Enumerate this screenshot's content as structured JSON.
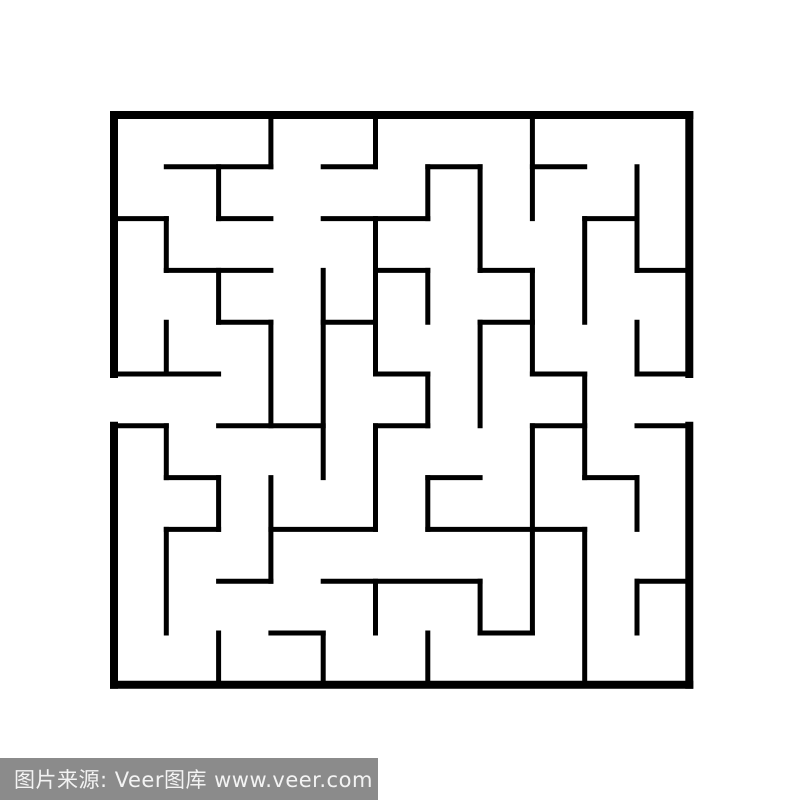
{
  "page": {
    "background": "#ffffff"
  },
  "maze": {
    "wall_color": "#000000",
    "background": "#ffffff",
    "grid": {
      "cols": 11,
      "rows": 11,
      "origin_x": 114,
      "origin_y": 115,
      "cell_w": 52.3,
      "cell_h": 51.8
    },
    "outer_wall_thickness": 8,
    "inner_wall_thickness": 5,
    "entrances": [
      {
        "side": "left",
        "row": 5
      },
      {
        "side": "right",
        "row": 5
      }
    ],
    "h_walls": [
      [
        0,
        0,
        11
      ],
      [
        1,
        1,
        3
      ],
      [
        1,
        4,
        5
      ],
      [
        1,
        6,
        7
      ],
      [
        1,
        8,
        9
      ],
      [
        2,
        0,
        1
      ],
      [
        2,
        2,
        3
      ],
      [
        2,
        4,
        6
      ],
      [
        2,
        9,
        10
      ],
      [
        3,
        1,
        3
      ],
      [
        3,
        5,
        6
      ],
      [
        3,
        7,
        8
      ],
      [
        3,
        10,
        11
      ],
      [
        4,
        2,
        3
      ],
      [
        4,
        4,
        5
      ],
      [
        4,
        7,
        8
      ],
      [
        5,
        0,
        2
      ],
      [
        5,
        5,
        6
      ],
      [
        5,
        8,
        9
      ],
      [
        5,
        10,
        11
      ],
      [
        6,
        0,
        1
      ],
      [
        6,
        2,
        4
      ],
      [
        6,
        5,
        6
      ],
      [
        6,
        8,
        9
      ],
      [
        6,
        10,
        11
      ],
      [
        7,
        1,
        2
      ],
      [
        7,
        6,
        7
      ],
      [
        7,
        9,
        10
      ],
      [
        8,
        1,
        2
      ],
      [
        8,
        3,
        5
      ],
      [
        8,
        6,
        9
      ],
      [
        9,
        2,
        3
      ],
      [
        9,
        4,
        7
      ],
      [
        9,
        10,
        11
      ],
      [
        10,
        3,
        4
      ],
      [
        10,
        7,
        8
      ],
      [
        11,
        0,
        11
      ]
    ],
    "v_walls": [
      [
        0,
        0,
        5
      ],
      [
        0,
        6,
        11
      ],
      [
        1,
        2,
        3
      ],
      [
        1,
        4,
        5
      ],
      [
        1,
        6,
        7
      ],
      [
        1,
        8,
        10
      ],
      [
        2,
        1,
        2
      ],
      [
        2,
        3,
        4
      ],
      [
        2,
        7,
        8
      ],
      [
        2,
        10,
        11
      ],
      [
        3,
        0,
        1
      ],
      [
        3,
        4,
        6
      ],
      [
        3,
        7,
        9
      ],
      [
        4,
        3,
        7
      ],
      [
        4,
        10,
        11
      ],
      [
        5,
        0,
        1
      ],
      [
        5,
        2,
        5
      ],
      [
        5,
        6,
        8
      ],
      [
        5,
        9,
        10
      ],
      [
        6,
        1,
        2
      ],
      [
        6,
        3,
        4
      ],
      [
        6,
        5,
        6
      ],
      [
        6,
        7,
        8
      ],
      [
        6,
        10,
        11
      ],
      [
        7,
        1,
        3
      ],
      [
        7,
        4,
        6
      ],
      [
        7,
        9,
        10
      ],
      [
        8,
        0,
        2
      ],
      [
        8,
        3,
        5
      ],
      [
        8,
        6,
        10
      ],
      [
        9,
        2,
        4
      ],
      [
        9,
        5,
        7
      ],
      [
        9,
        8,
        11
      ],
      [
        10,
        1,
        3
      ],
      [
        10,
        4,
        5
      ],
      [
        10,
        7,
        8
      ],
      [
        10,
        9,
        10
      ],
      [
        11,
        0,
        5
      ],
      [
        11,
        6,
        11
      ]
    ]
  },
  "watermark": {
    "text": "图片来源: Veer图库 www.veer.com",
    "label": "图片来源:",
    "source_name": "Veer图库",
    "url": "www.veer.com",
    "bar_color": "#8b8b8b",
    "text_color": "#f3f3f3"
  }
}
